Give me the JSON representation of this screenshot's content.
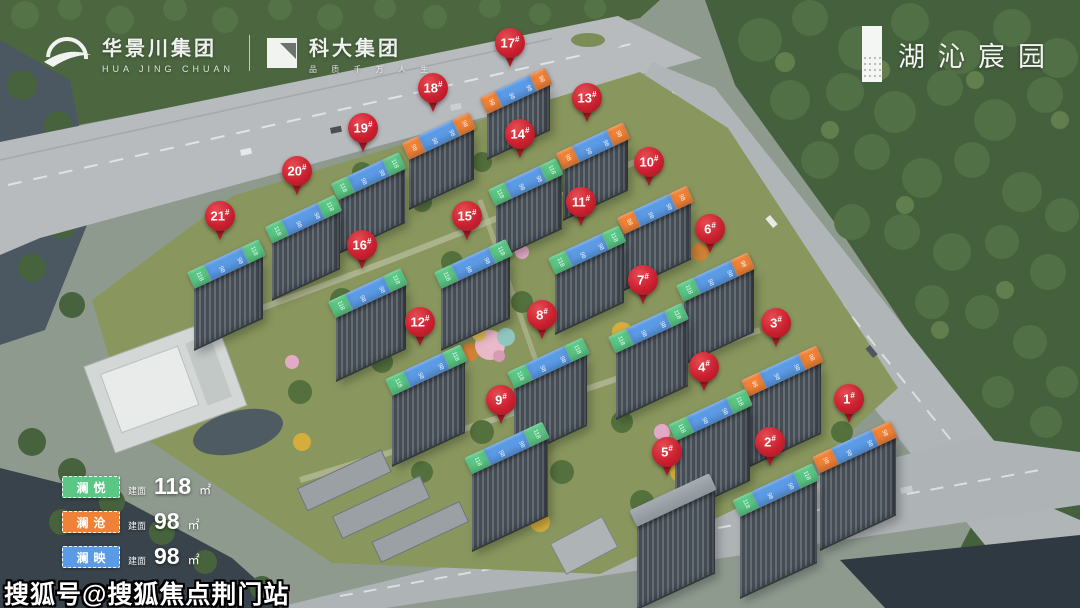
{
  "brand_bar": {
    "left": {
      "logo1_name": "华景川集团",
      "logo1_sub": "HUA JING CHUAN",
      "divider": "|",
      "logo2_name": "科大集团",
      "logo2_sub": "品 质 千 万 人 生"
    },
    "right": {
      "project_name": "湖沁宸园"
    }
  },
  "legend": {
    "items": [
      {
        "name": "澜悦",
        "color_key": "green",
        "area_label": "建面",
        "area_value": "118",
        "area_unit": "㎡"
      },
      {
        "name": "澜沧",
        "color_key": "orange",
        "area_label": "建面",
        "area_value": "98",
        "area_unit": "㎡"
      },
      {
        "name": "澜映",
        "color_key": "blue",
        "area_label": "建面",
        "area_value": "98",
        "area_unit": "㎡"
      }
    ]
  },
  "watermark": "搜狐号@搜狐焦点荆门站",
  "colors": {
    "green": "#5ac785",
    "orange": "#f08238",
    "blue": "#5b9ae4",
    "pin_red": "#cb2030"
  },
  "markers": {
    "suffix": "#",
    "band_labels": {
      "green": "118",
      "orange": "98",
      "blue": "98"
    },
    "buildings": [
      {
        "num": "1",
        "x": 849,
        "y": 401,
        "bands": [
          "orange",
          "blue",
          "orange"
        ]
      },
      {
        "num": "2",
        "x": 770,
        "y": 444,
        "bands": [
          "green",
          "blue",
          "green"
        ]
      },
      {
        "num": "3",
        "x": 776,
        "y": 325,
        "bands": [
          "orange",
          "blue",
          "orange"
        ]
      },
      {
        "num": "4",
        "x": 704,
        "y": 369,
        "bands": [
          "green",
          "blue",
          "green"
        ]
      },
      {
        "num": "5",
        "x": 667,
        "y": 454,
        "bands": []
      },
      {
        "num": "6",
        "x": 710,
        "y": 231,
        "bands": [
          "green",
          "blue",
          "orange"
        ]
      },
      {
        "num": "7",
        "x": 643,
        "y": 282,
        "bands": [
          "green",
          "blue",
          "green"
        ]
      },
      {
        "num": "8",
        "x": 542,
        "y": 317,
        "bands": [
          "green",
          "blue",
          "green"
        ]
      },
      {
        "num": "9",
        "x": 501,
        "y": 402,
        "bands": [
          "green",
          "blue",
          "green"
        ]
      },
      {
        "num": "10",
        "x": 649,
        "y": 164,
        "bands": [
          "orange",
          "blue",
          "orange"
        ]
      },
      {
        "num": "11",
        "x": 581,
        "y": 204,
        "bands": [
          "green",
          "blue",
          "green"
        ]
      },
      {
        "num": "12",
        "x": 420,
        "y": 324,
        "bands": [
          "green",
          "blue",
          "green"
        ]
      },
      {
        "num": "13",
        "x": 587,
        "y": 100,
        "bands": [
          "orange",
          "blue",
          "orange"
        ]
      },
      {
        "num": "14",
        "x": 520,
        "y": 136,
        "bands": [
          "green",
          "blue",
          "green"
        ]
      },
      {
        "num": "15",
        "x": 467,
        "y": 218,
        "bands": [
          "green",
          "blue",
          "green"
        ]
      },
      {
        "num": "16",
        "x": 362,
        "y": 247,
        "bands": [
          "green",
          "blue",
          "green"
        ]
      },
      {
        "num": "17",
        "x": 510,
        "y": 45,
        "bands": [
          "orange",
          "blue",
          "orange"
        ]
      },
      {
        "num": "18",
        "x": 433,
        "y": 90,
        "bands": [
          "orange",
          "blue",
          "orange"
        ]
      },
      {
        "num": "19",
        "x": 363,
        "y": 130,
        "bands": [
          "green",
          "blue",
          "green"
        ]
      },
      {
        "num": "20",
        "x": 297,
        "y": 173,
        "bands": [
          "green",
          "blue",
          "green"
        ]
      },
      {
        "num": "21",
        "x": 220,
        "y": 218,
        "bands": [
          "green",
          "blue",
          "green"
        ]
      }
    ]
  }
}
